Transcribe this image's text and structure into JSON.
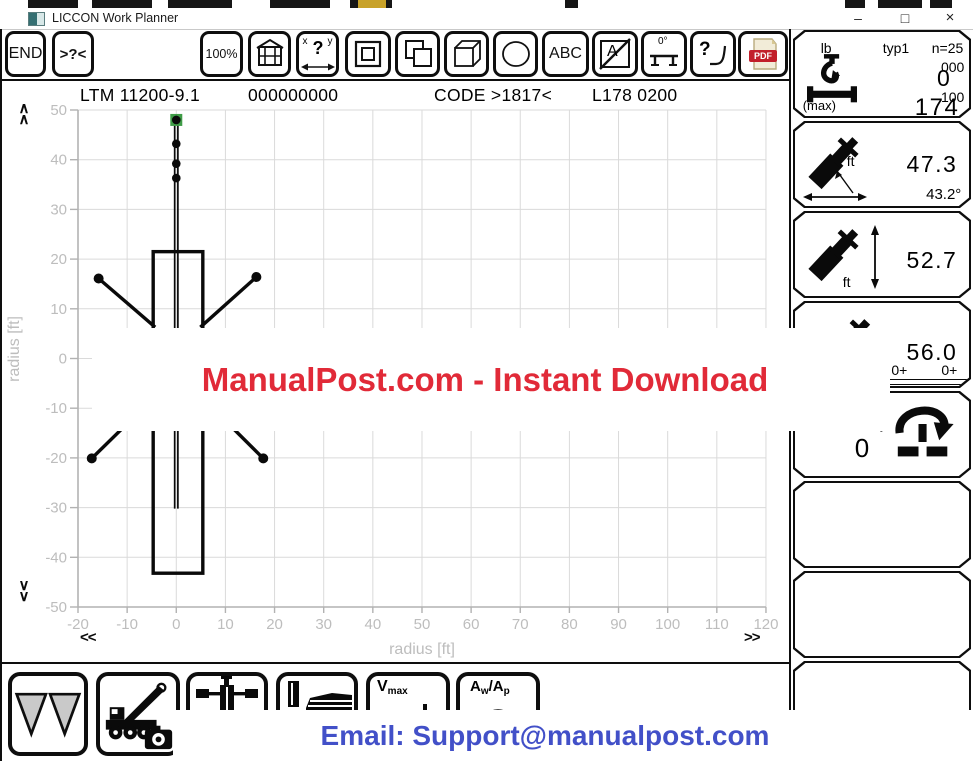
{
  "window": {
    "title": "LICCON Work Planner",
    "minimize": "–",
    "maximize": "□",
    "close": "×"
  },
  "toolbar": {
    "end": "END",
    "search": ">?<",
    "zoom": "100%",
    "xy_x": "x",
    "xy_y": "y",
    "xy_q": "?",
    "abc": "ABC",
    "a_label": "A",
    "angle_label": "0°",
    "q_label": "?",
    "pdf": "PDF"
  },
  "header": {
    "model": "LTM 11200-9.1",
    "serial": "000000000",
    "code": "CODE >1817<",
    "config": "L178 0200"
  },
  "plot": {
    "xlabel": "radius [ft]",
    "ylabel": "radius [ft]",
    "x_ticks": [
      -20,
      -10,
      0,
      10,
      20,
      30,
      40,
      50,
      60,
      70,
      80,
      90,
      100,
      110,
      120
    ],
    "y_ticks": [
      50,
      40,
      30,
      20,
      10,
      0,
      -10,
      -20,
      -30,
      -40,
      -50
    ],
    "scroll_up": "∧",
    "scroll_down": "∨",
    "scroll_left": "<<",
    "scroll_right": ">>",
    "grid_color": "#dadada",
    "axis_color": "#b2b2b2",
    "tick_label_color": "#bdbdbd",
    "crane": {
      "line_color": "#0a0a0a",
      "marker_color": "#3f9c47",
      "body_rect": {
        "x1": -4.7,
        "y1": 21.5,
        "x2": 5.4,
        "y2": -43.2
      },
      "boom_line": {
        "x": 0,
        "y_top": 48.6,
        "y_bottom": -30.2
      },
      "hook_dots": [
        [
          0,
          48.0
        ],
        [
          0,
          43.2
        ],
        [
          0,
          39.2
        ],
        [
          0,
          36.3
        ]
      ],
      "marker": {
        "x": 0,
        "y": 48.0
      },
      "outriggers": [
        {
          "from": [
            -4.3,
            6.3
          ],
          "to": [
            -15.8,
            16.1
          ]
        },
        {
          "from": [
            4.9,
            6.3
          ],
          "to": [
            16.3,
            16.4
          ]
        },
        {
          "from": [
            -4.7,
            -8.0
          ],
          "to": [
            -17.2,
            -20.1
          ]
        },
        {
          "from": [
            5.4,
            -8.0
          ],
          "to": [
            17.7,
            -20.1
          ]
        }
      ]
    }
  },
  "sidebar": {
    "panels": [
      {
        "unit": "lb",
        "type": "typ1",
        "count": "n=25",
        "aux_top": "000",
        "value_top": "0",
        "aux_bottom": "100",
        "value_bottom": "174",
        "caption": "(max)"
      },
      {
        "value": "47.3",
        "angle": "43.2°",
        "unit": "ft"
      },
      {
        "value": "52.7",
        "unit": "ft"
      },
      {
        "value": "56.0",
        "counters": [
          "0+",
          "0+",
          "0+"
        ]
      },
      {
        "value": "0",
        "degree": "°"
      }
    ]
  },
  "bottom_toolbar": {
    "vmax_main": "V",
    "vmax_sub": "max",
    "aw_main": "A",
    "aw_sub": "w",
    "slash": "/",
    "ap_main": "A",
    "ap_sub": "p"
  },
  "watermarks": {
    "banner_text": "ManualPost.com - Instant Download",
    "banner_color": "#e12a38",
    "email_text": "Email: Support@manualpost.com",
    "email_color": "#4250c8"
  }
}
